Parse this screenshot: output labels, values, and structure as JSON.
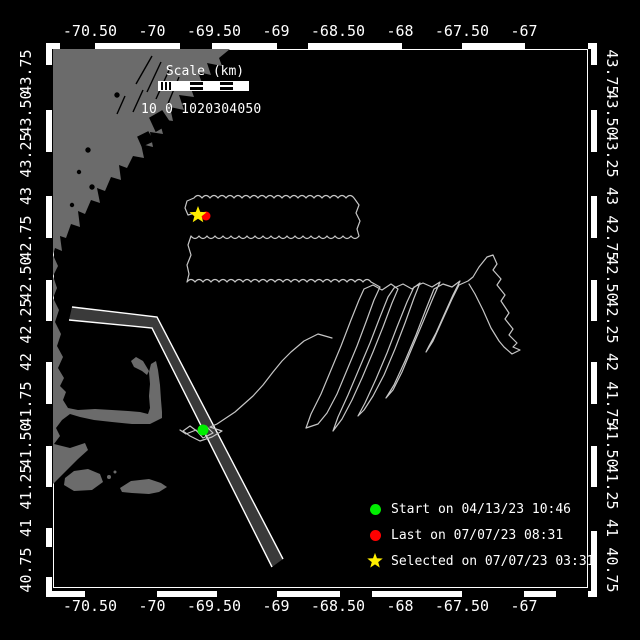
{
  "colors": {
    "background": "#000000",
    "land": "#6b6b6b",
    "track": "#c6c6c6",
    "shipping_lane_fill": "#3a3a3a",
    "frame": "#ffffff",
    "text": "#ffffff",
    "start_green": "#00ee00",
    "last_red": "#ff0000",
    "selected_yellow": "#ffee00"
  },
  "axes": {
    "lon_labels": [
      {
        "text": "-70.50",
        "x": 90
      },
      {
        "text": "-70",
        "x": 152
      },
      {
        "text": "-69.50",
        "x": 214
      },
      {
        "text": "-69",
        "x": 276
      },
      {
        "text": "-68.50",
        "x": 338
      },
      {
        "text": "-68",
        "x": 400
      },
      {
        "text": "-67.50",
        "x": 462
      },
      {
        "text": "-67",
        "x": 524
      }
    ],
    "lat_labels": [
      {
        "text": "43.75",
        "y": 72
      },
      {
        "text": "43.50",
        "y": 113
      },
      {
        "text": "43.25",
        "y": 155
      },
      {
        "text": "43",
        "y": 196
      },
      {
        "text": "42.75",
        "y": 238
      },
      {
        "text": "42.50",
        "y": 279
      },
      {
        "text": "42.25",
        "y": 321
      },
      {
        "text": "42",
        "y": 362
      },
      {
        "text": "41.75",
        "y": 404
      },
      {
        "text": "41.50",
        "y": 445
      },
      {
        "text": "41.25",
        "y": 487
      },
      {
        "text": "41",
        "y": 528
      },
      {
        "text": "40.75",
        "y": 570
      }
    ]
  },
  "map_frame": {
    "top_black": [
      [
        60,
        95
      ],
      [
        180,
        212
      ],
      [
        277,
        308
      ],
      [
        402,
        462
      ],
      [
        525,
        588
      ]
    ],
    "bottom_black": [
      [
        85,
        157
      ],
      [
        217,
        277
      ],
      [
        340,
        372
      ],
      [
        462,
        524
      ],
      [
        556,
        588
      ]
    ],
    "left_black": [
      [
        65,
        110
      ],
      [
        152,
        196
      ],
      [
        238,
        280
      ],
      [
        321,
        362
      ],
      [
        404,
        446
      ],
      [
        487,
        528
      ],
      [
        547,
        577
      ]
    ],
    "right_black": [
      [
        65,
        110
      ],
      [
        152,
        196
      ],
      [
        238,
        280
      ],
      [
        321,
        362
      ],
      [
        404,
        446
      ],
      [
        487,
        531
      ]
    ]
  },
  "scale_bar": {
    "title": "Scale (km)",
    "tick_labels": "10 0 1020304050"
  },
  "legend": {
    "items": [
      {
        "marker": "dot",
        "color": "#00ee00",
        "label": "Start on 04/13/23 10:46"
      },
      {
        "marker": "dot",
        "color": "#ff0000",
        "label": "Last on 07/07/23 08:31"
      },
      {
        "marker": "star",
        "color": "#ffee00",
        "label": "Selected on 07/07/23 03:31"
      }
    ]
  },
  "markers": {
    "start": {
      "x": 203,
      "y": 430
    },
    "last": {
      "x": 206,
      "y": 216
    },
    "selected": {
      "x": 198,
      "y": 215
    }
  }
}
